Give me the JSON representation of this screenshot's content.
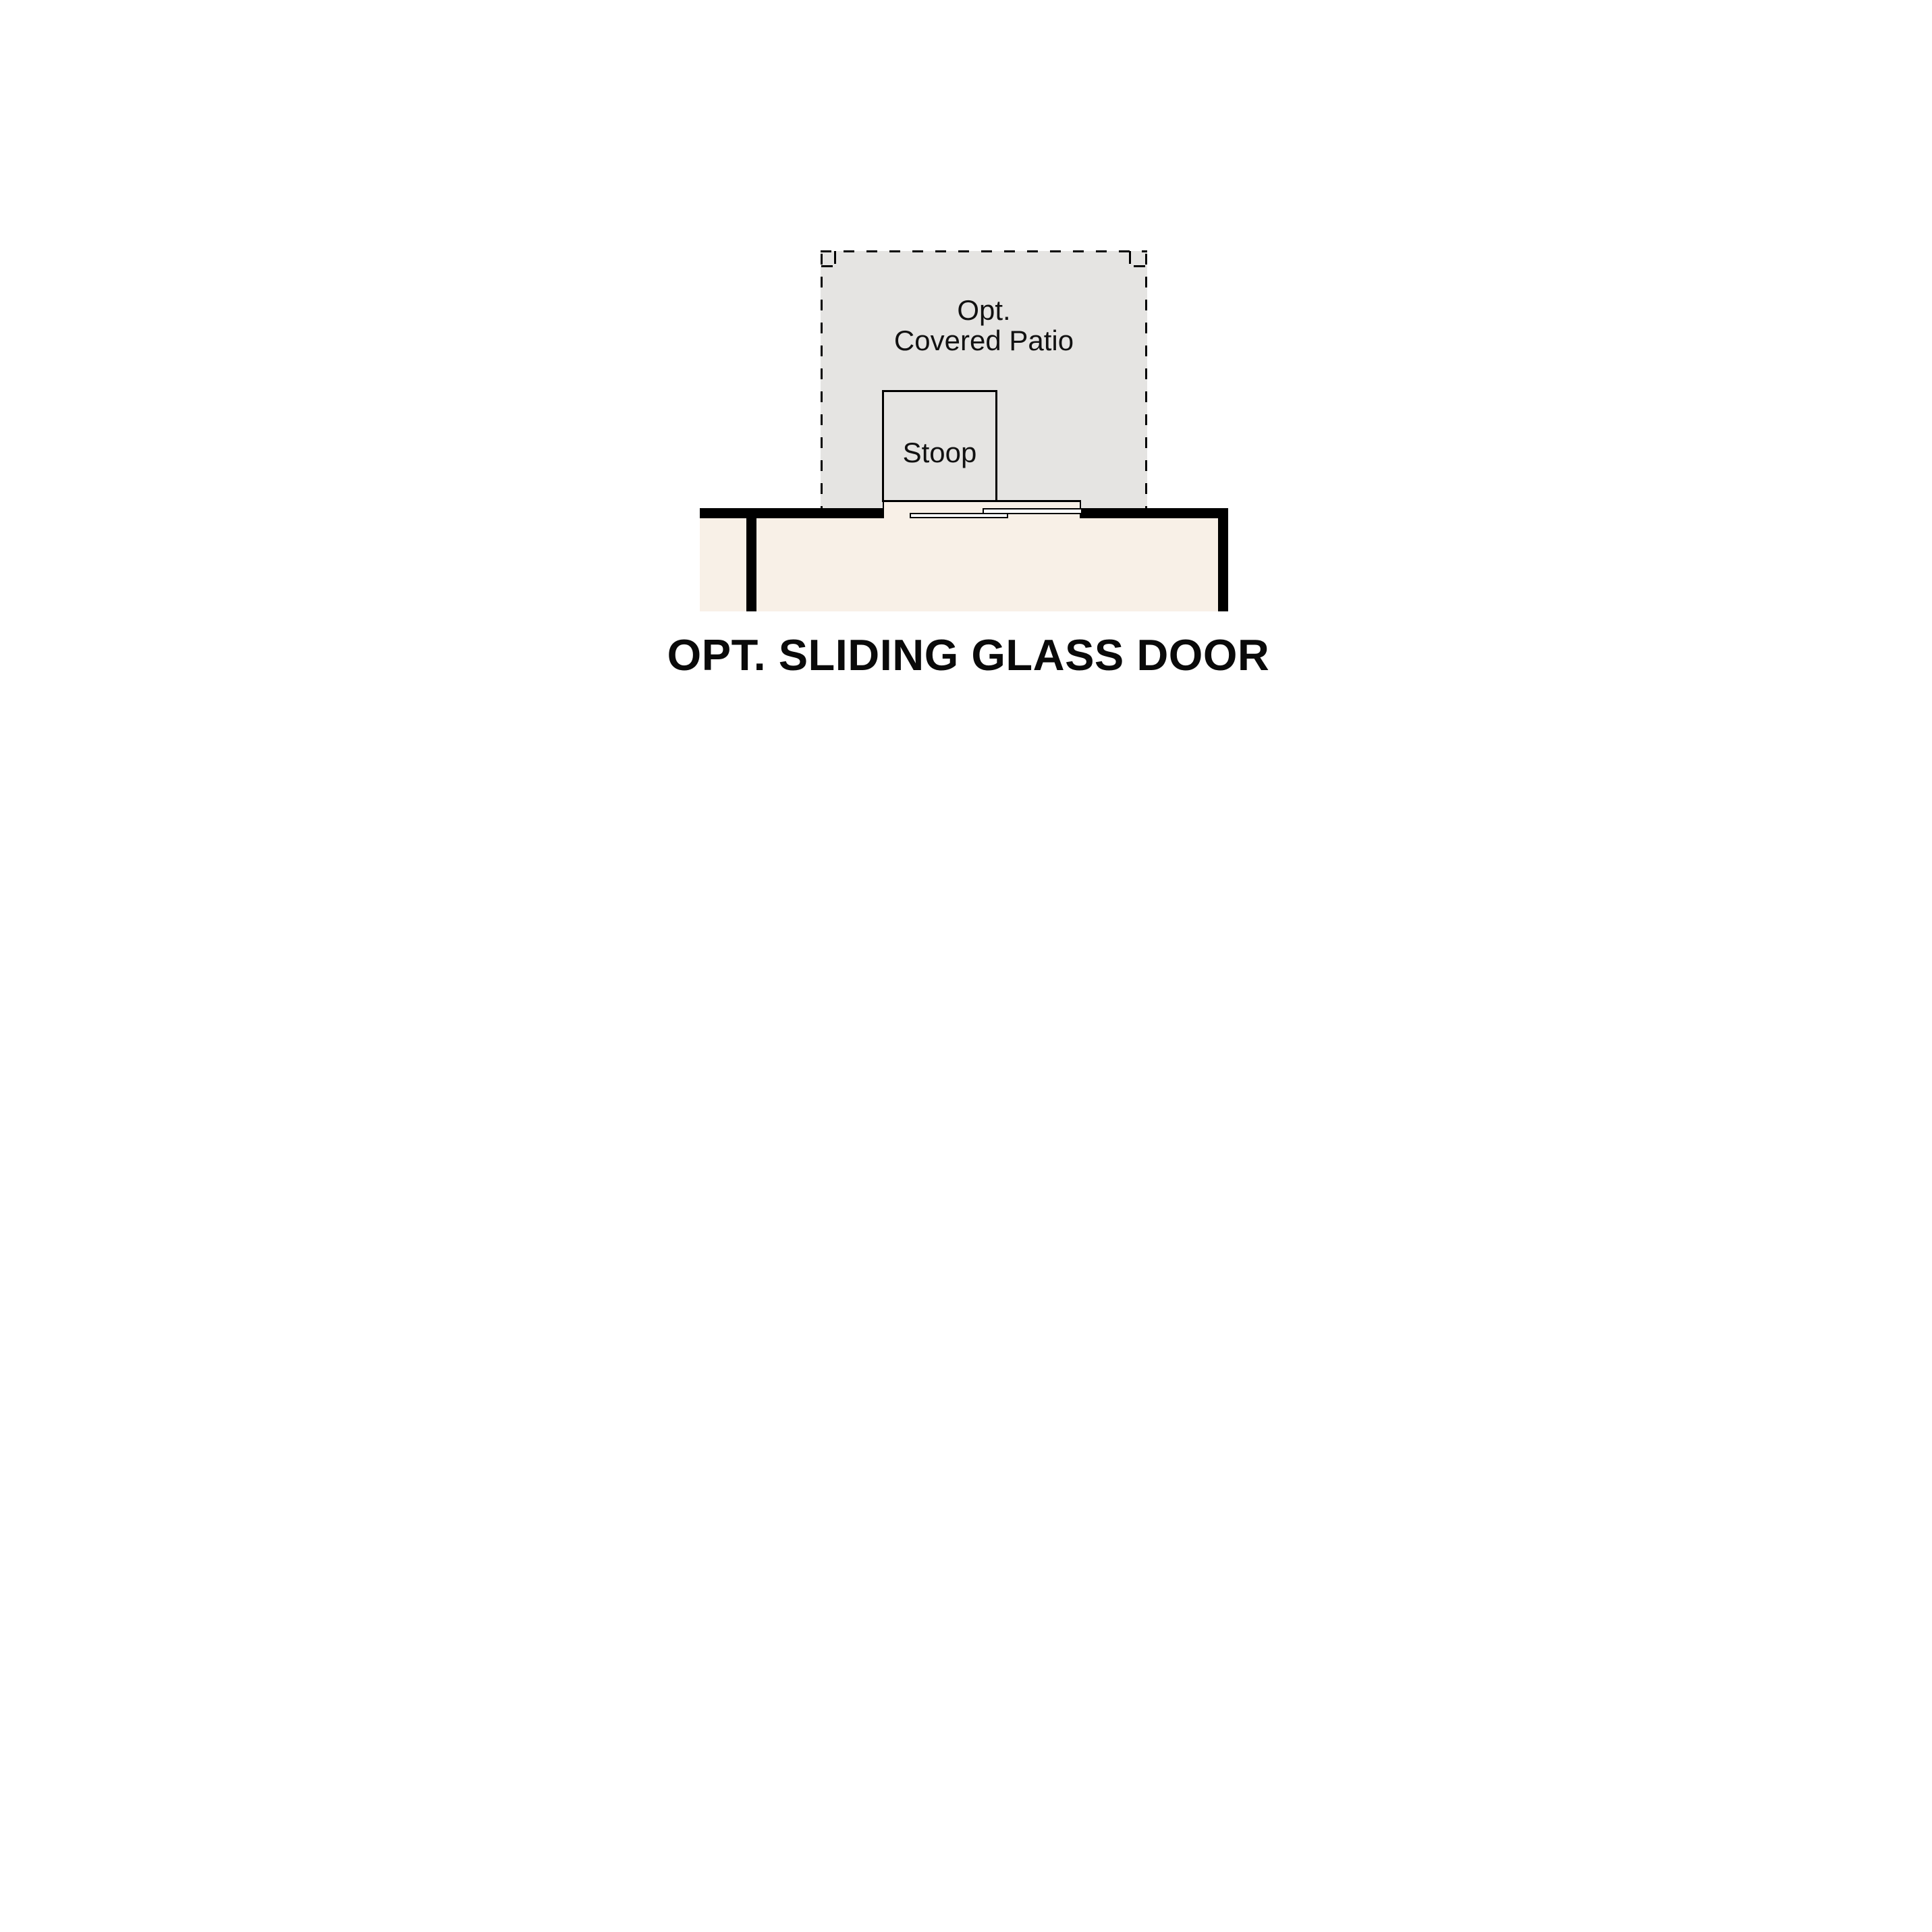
{
  "diagram": {
    "title": "OPT. SLIDING GLASS DOOR",
    "patio": {
      "label_line1": "Opt.",
      "label_line2": "Covered Patio"
    },
    "stoop": {
      "label": "Stoop"
    },
    "colors": {
      "background": "#ffffff",
      "patio_fill": "#e5e4e2",
      "interior_fill": "#f8f0e7",
      "wall": "#000000",
      "door_panel_fill": "#ffffff",
      "text": "#111111"
    }
  }
}
